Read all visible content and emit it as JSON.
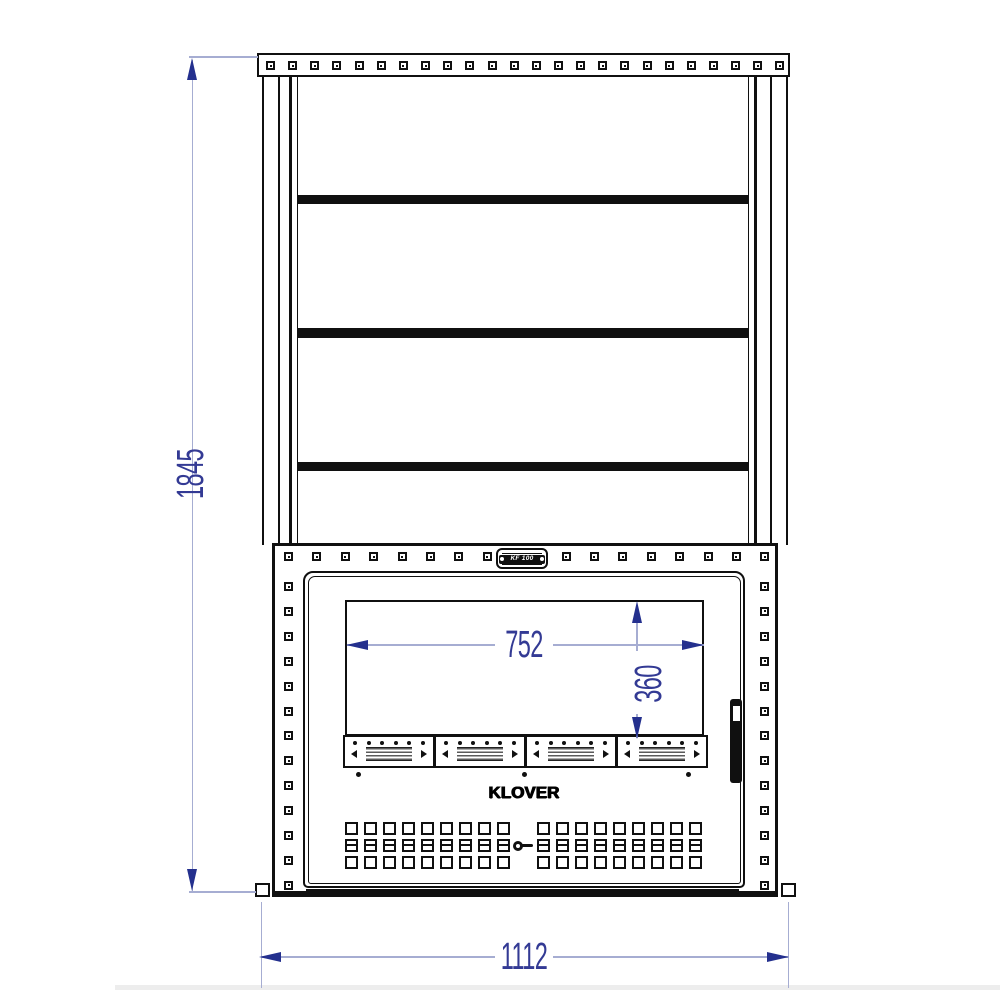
{
  "drawing": {
    "description": "Front elevation technical drawing of a wood fireplace insert with shelf frame"
  },
  "branding": {
    "logo_text": "KLOVER",
    "badge_text": "KF 100"
  },
  "dimensions": {
    "overall_height": "1845",
    "overall_width": "1112",
    "glass_width": "752",
    "glass_height": "360"
  },
  "colors": {
    "linework": "#101010",
    "dimension_accent": "#24308e",
    "dimension_text": "#333a94",
    "dimension_line": "#a6add2",
    "background": "#ffffff"
  },
  "hardware": {
    "top_rail_bolts": 24,
    "frame_top_bolts_per_side": 8,
    "frame_side_bolts": 13,
    "shelf_bars": 3,
    "vent_modules": 4,
    "vent_dots_per_module": 6,
    "grid_rows": 3,
    "grid_cols_per_side": 9,
    "screw_dots": 3
  }
}
